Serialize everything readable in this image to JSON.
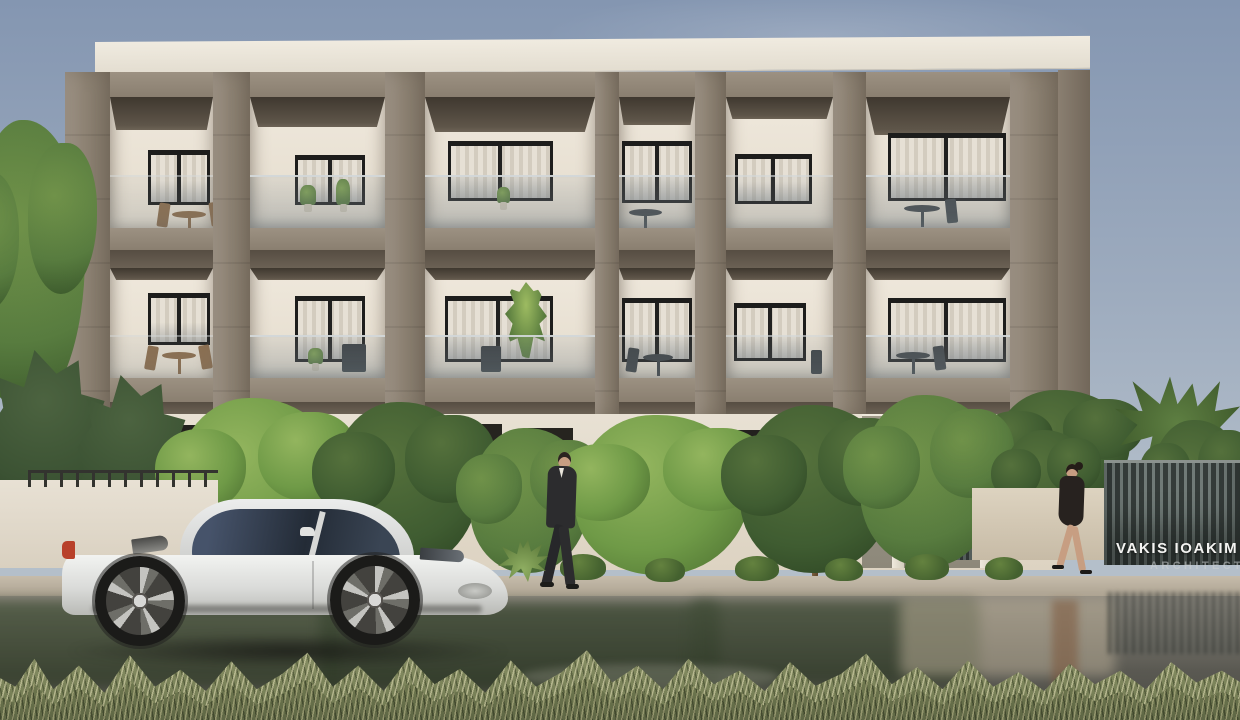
{
  "watermark": {
    "studio_name": "VAKIS IOAKIM",
    "studio_subtitle": "ARCHITECTS"
  },
  "palette": {
    "sky_top": "#8496b1",
    "sky_horizon": "#b4bfca",
    "concrete": "#8d8273",
    "concrete_light": "#9c9182",
    "concrete_dark": "#6f6456",
    "slab_shadow": "#564d42",
    "wall_white": "#ece5d8",
    "wall_shade": "#ddd3c3",
    "window_frame": "#1d1d1c",
    "curtain_light": "#e6e0d5",
    "curtain_shade": "#d3ccbf",
    "glass_rail_tint": "#96a0a6",
    "foliage_light": "#6f9a47",
    "foliage_mid": "#567a3e",
    "foliage_dark": "#3f5c31",
    "trunk": "#6b5134",
    "road_dry": "#8f8a80",
    "road_dark": "#50504a",
    "wet_reflection_green": "#414d38",
    "curb": "#c3b9a8",
    "grass_khaki": "#7b835c",
    "grass_light": "#b7b184",
    "car_body": "#e6e7e5",
    "car_glass": "#2e3744",
    "tire": "#1b1b19",
    "taillight": "#b8402a",
    "fence_slat_light": "#707a77",
    "fence_slat_dark": "#353c3a",
    "skin": "#c79e82",
    "suit": "#2c2c2e"
  },
  "scene": {
    "type": "architectural-exterior-render",
    "building": {
      "storeys_visible": 2,
      "bays_per_storey": 6,
      "features": [
        "concrete grid frame",
        "glass balcony railings",
        "curtained sliding windows",
        "patio furniture",
        "potted plants",
        "white parapet roof"
      ]
    },
    "street": {
      "vehicle": "white sports car",
      "pedestrians": [
        "man in dark suit",
        "woman in black dress"
      ],
      "surface": "wet road with tree and fence reflections",
      "foreground": "dry grass tufts"
    }
  }
}
